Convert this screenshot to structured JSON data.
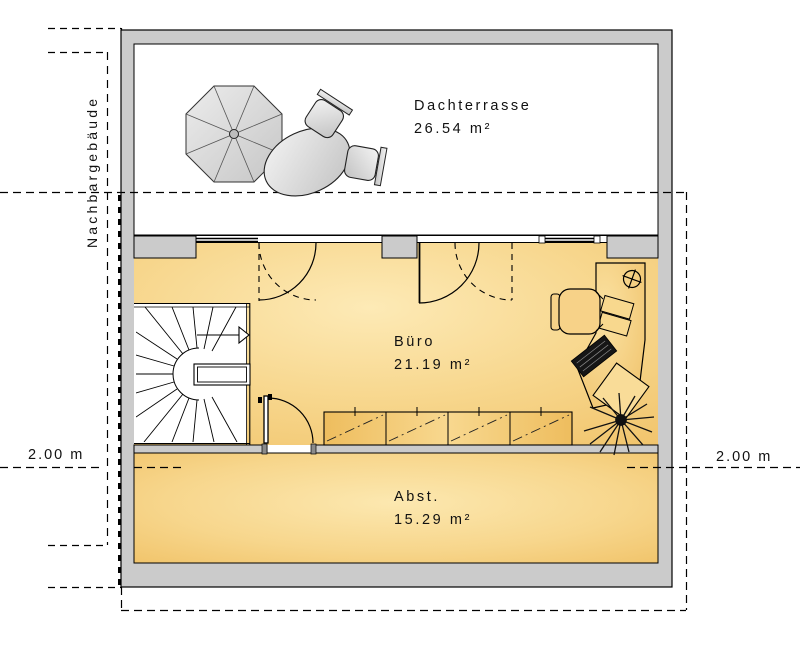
{
  "plan": {
    "type": "floor-plan",
    "rooms": [
      {
        "name": "Dachterrasse",
        "area": "26.54 m²"
      },
      {
        "name": "Büro",
        "area": "21.19 m²"
      },
      {
        "name": "Abst.",
        "area": "15.29 m²"
      }
    ],
    "annotations": {
      "neighbor_building": "Nachbargebäude",
      "left_distance": "2.00 m",
      "right_distance": "2.00 m"
    },
    "colors": {
      "wall": "#cbcbcb",
      "outline": "#000000",
      "floor": "#f2c46c",
      "floor_light": "#fdeab6",
      "terrace": "#ffffff",
      "furniture_gray": "#d6d6d6"
    }
  }
}
